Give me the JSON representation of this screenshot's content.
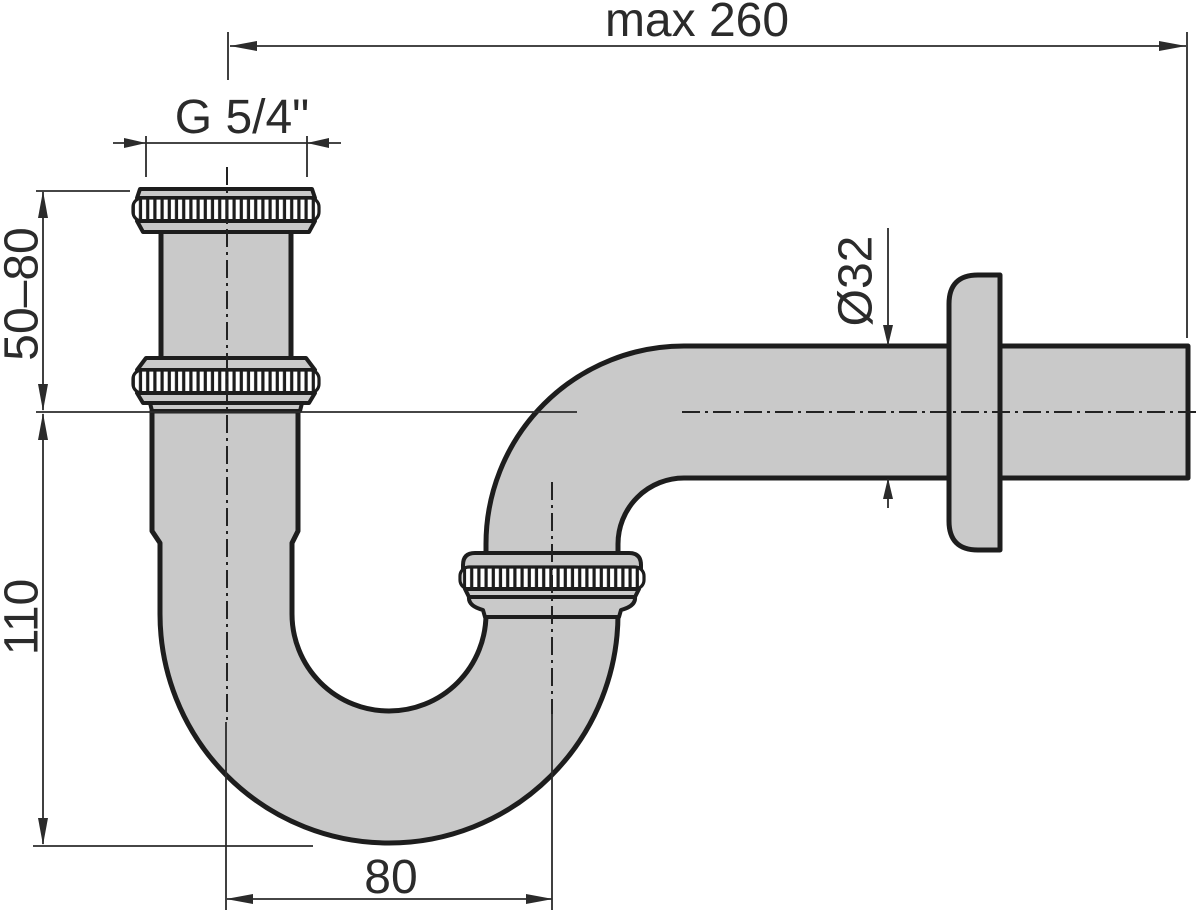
{
  "labels": {
    "max_width": "max 260",
    "inlet_thread": "G 5/4\"",
    "inlet_height_range": "50–80",
    "trap_depth": "110",
    "pipe_diameter": "Ø32",
    "bend_offset": "80"
  },
  "colors": {
    "background": "#ffffff",
    "pipe_fill": "#c9c9c9",
    "outline": "#1d1d1d",
    "dimension_lines": "#2b2b2b",
    "text": "#2b2b2b"
  }
}
